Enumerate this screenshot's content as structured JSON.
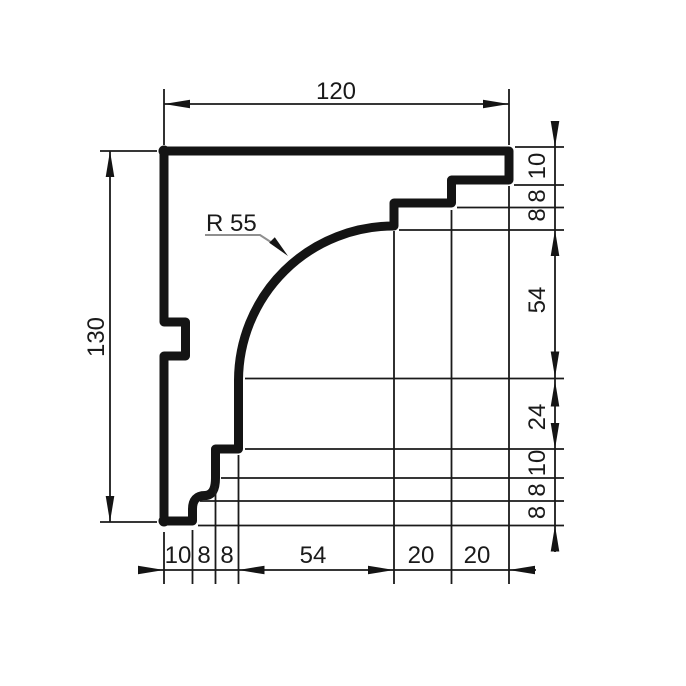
{
  "drawing": {
    "kind": "cornice-profile-section",
    "radius_label": "R 55",
    "dim_top": "120",
    "dim_left": "130",
    "dims_right": [
      "10",
      "8",
      "8",
      "54",
      "24",
      "10",
      "8",
      "8"
    ],
    "dims_bottom": [
      "10",
      "8",
      "8",
      "54",
      "20",
      "20"
    ],
    "colors": {
      "ink": "#141414",
      "leader_gray": "#8f8f8f",
      "background": "#ffffff"
    }
  }
}
